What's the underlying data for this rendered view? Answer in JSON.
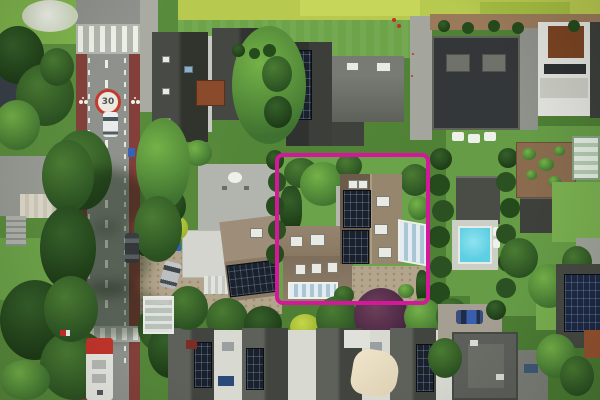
{
  "photo": {
    "kind": "aerial-drone-photo",
    "subject": "top-down aerial view of a suburban neighborhood with one property plot outlined in magenta (real-estate style highlight)",
    "visible_text": {
      "road_speed_limit": "30"
    }
  },
  "highlight": {
    "name": "property-boundary-rectangle",
    "shape": "rounded-rectangle",
    "color": "#d5189b",
    "left_px": 275,
    "top_px": 153,
    "width_px": 155,
    "height_px": 152,
    "corner_radius_px": 8,
    "stroke_px": 4
  },
  "palette": {
    "magenta": "#d5189b",
    "asphalt": "#8e918c",
    "bikeLane": "#83403a",
    "pavement": "#a9aaa1",
    "plateau": "#b3b6af",
    "red30": "#c23b2e",
    "lawn": "#6ba34a",
    "waterweed": "#b7c94f",
    "gravel": "#b3a58b",
    "solar": "#1b212b",
    "poolBlue": "#5ccfe2",
    "roofBrown": "#8a7a66",
    "roofBrownDark": "#6a5b4b",
    "roofBrownLight": "#97866e",
    "roofDark": "#34373a",
    "busRed": "#c0342b",
    "carBlue": "#3a5fae"
  },
  "scene_elements": [
    "duckweed-covered-waterway",
    "zebra-crossing-raised-plateau",
    "speed-limit-30-road-roundel",
    "red-bike-lanes",
    "painted-bicycle-symbols",
    "dashed-center-line",
    "speed-bump",
    "white-car",
    "dark-parked-car",
    "red-white-bus",
    "bus-stop-shelter",
    "dark-roof-houses",
    "solar-panel-arrays",
    "rust-colored-flat-roof-section",
    "highlighted-house-brown-roof",
    "roof-windows",
    "glass-veranda",
    "glass-conservatory",
    "garden-parasols",
    "satellite-dish",
    "gravel-driveways",
    "silver-car",
    "yellow-flowering-shrub",
    "swimming-pool",
    "pool-deck-loungers",
    "trimmed-hedges",
    "vegetable-garden",
    "greenhouse",
    "terraced-houses-row",
    "cream-shade-sail",
    "purple-leaved-tree",
    "blue-car",
    "lawns",
    "trees"
  ]
}
